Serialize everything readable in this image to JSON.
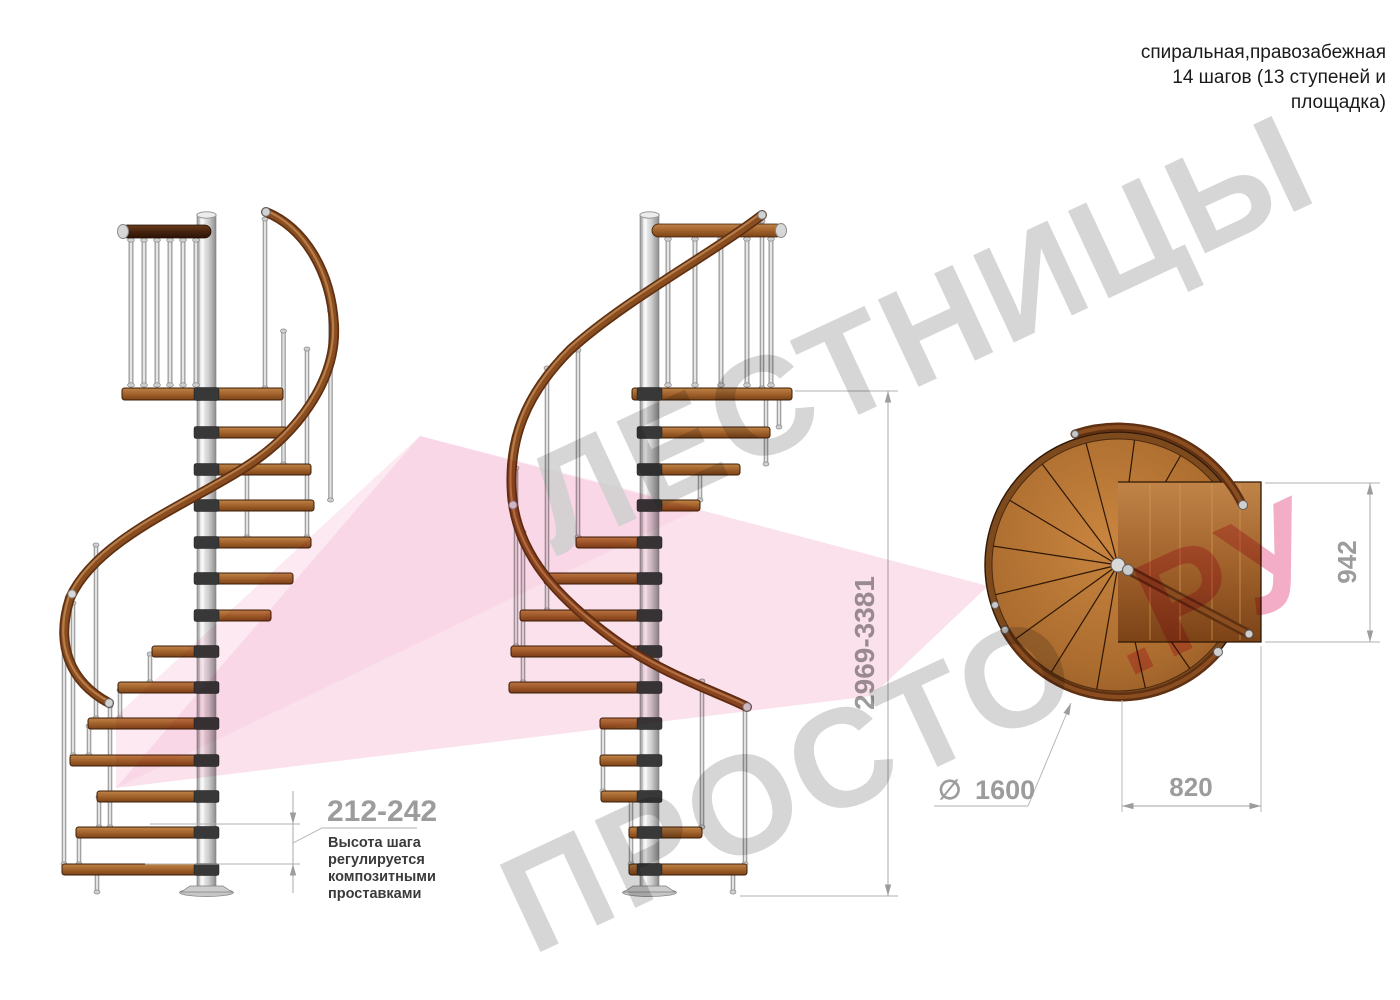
{
  "header": {
    "lines": [
      "спиральная,правозабежная",
      "14 шагов (13 ступеней и",
      "площадка)"
    ]
  },
  "watermark": {
    "word1": "ЛЕСТНИЦЫ",
    "word2": "ПРОСТО",
    "word2_suffix": ".РУ",
    "grey": "#cfcfcf",
    "pink": "#f19fbc",
    "ribbon_light": "#fbe4ef",
    "ribbon_mid": "#f5c8dd"
  },
  "dimensions": {
    "step_height": {
      "value": "212-242",
      "note_lines": [
        "Высота шага",
        "регулируется",
        "композитными",
        "проставками"
      ]
    },
    "total_height": {
      "value": "2969-3381"
    },
    "landing_depth": {
      "value": "942"
    },
    "landing_width": {
      "value": "820"
    },
    "diameter": {
      "symbol": "∅",
      "value": "1600"
    }
  },
  "colors": {
    "dim": "#9c9c9c",
    "ext": "#b0b0b0",
    "note": "#3a3a3a",
    "header": "#1a1a1a",
    "wood": "#a96a2e",
    "wood_dark": "#6e3b16",
    "rail": "#7b4019",
    "steel": "#d2d2d2"
  }
}
